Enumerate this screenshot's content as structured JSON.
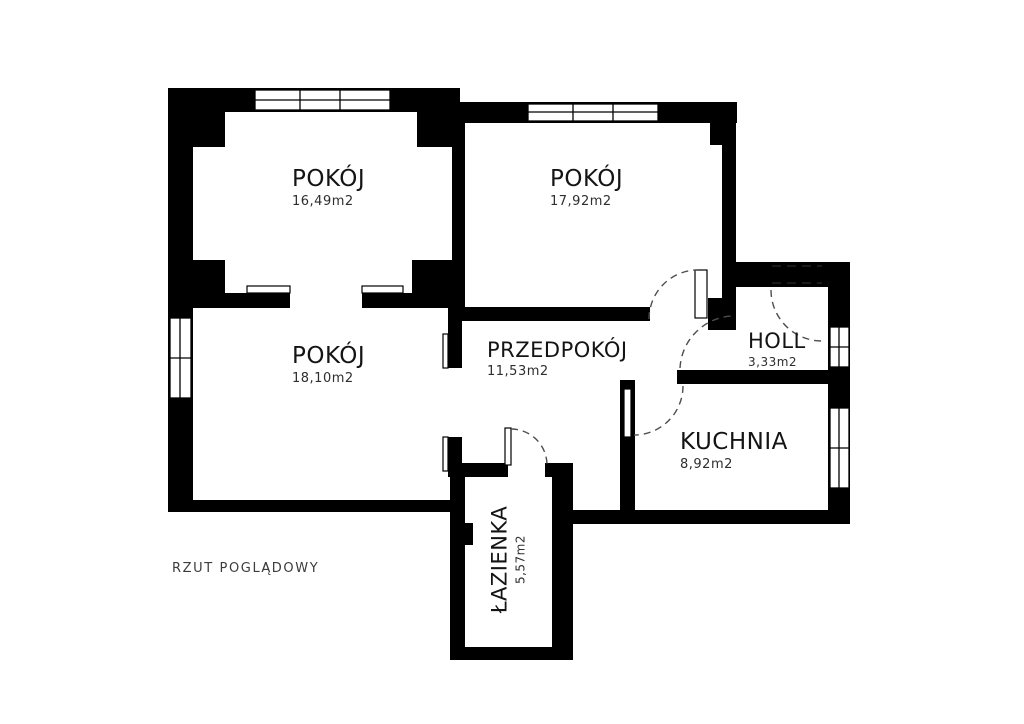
{
  "plan": {
    "caption": "RZUT POGLĄDOWY",
    "rooms": [
      {
        "id": "pokoj-1",
        "label": "POKÓJ",
        "area": "16,49m2"
      },
      {
        "id": "pokoj-2",
        "label": "POKÓJ",
        "area": "17,92m2"
      },
      {
        "id": "pokoj-3",
        "label": "POKÓJ",
        "area": "18,10m2"
      },
      {
        "id": "przedpokoj",
        "label": "PRZEDPOKÓJ",
        "area": "11,53m2"
      },
      {
        "id": "holl",
        "label": "HOLL",
        "area": "3,33m2"
      },
      {
        "id": "kuchnia",
        "label": "KUCHNIA",
        "area": "8,92m2"
      },
      {
        "id": "lazienka",
        "label": "ŁAZIENKA",
        "area": "5,57m2"
      }
    ],
    "colors": {
      "wall": "#000000",
      "background": "#ffffff",
      "label": "#141414",
      "caption": "#3c3c3c",
      "door_arc": "#4d4d4d"
    }
  }
}
